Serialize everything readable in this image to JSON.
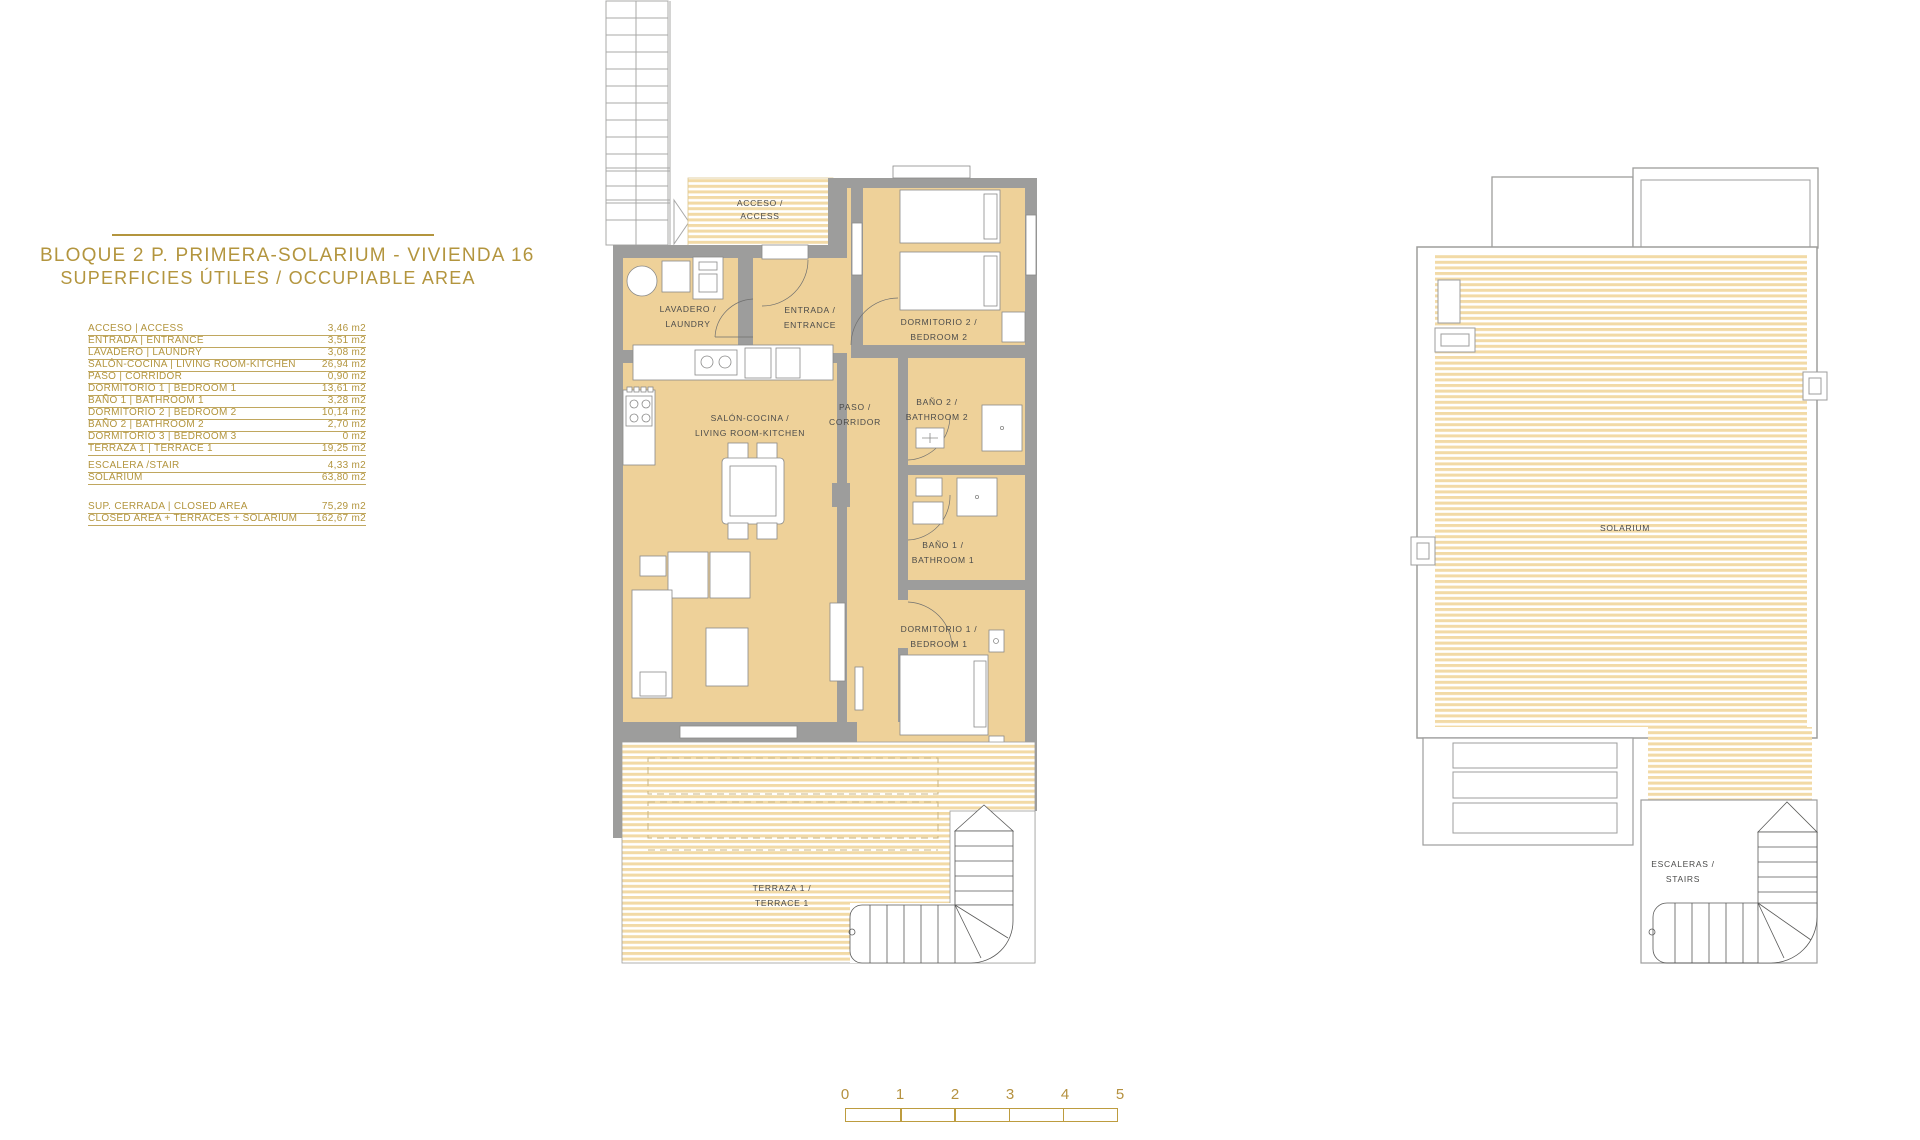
{
  "title_block": {
    "line1": "BLOQUE 2 P. PRIMERA-SOLARIUM - VIVIENDA 16",
    "line2": "SUPERFICIES ÚTILES / OCCUPIABLE AREA"
  },
  "area_table": {
    "rows": [
      {
        "label": "ACCESO | ACCESS",
        "value": "3,46 m2"
      },
      {
        "label": "ENTRADA | ENTRANCE",
        "value": "3,51 m2"
      },
      {
        "label": "LAVADERO | LAUNDRY",
        "value": "3,08 m2"
      },
      {
        "label": "SALÓN-COCINA | LIVING ROOM-KITCHEN",
        "value": "26,94 m2"
      },
      {
        "label": "PASO | CORRIDOR",
        "value": "0,90 m2"
      },
      {
        "label": "DORMITORIO 1 | BEDROOM 1",
        "value": "13,61 m2"
      },
      {
        "label": "BAÑO 1 | BATHROOM 1",
        "value": "3,28 m2"
      },
      {
        "label": "DORMITORIO 2 | BEDROOM 2",
        "value": "10,14 m2"
      },
      {
        "label": "BAÑO 2 | BATHROOM 2",
        "value": "2,70 m2"
      },
      {
        "label": "DORMITORIO 3 | BEDROOM 3",
        "value": "0 m2"
      },
      {
        "label": "TERRAZA 1 | TERRACE 1",
        "value": "19,25 m2"
      },
      {
        "label": "ESCALERA /STAIR",
        "value": "4,33 m2"
      },
      {
        "label": "SOLARIUM",
        "value": "63,80 m2"
      }
    ],
    "totals": [
      {
        "label": "SUP. CERRADA | CLOSED AREA",
        "value": "75,29 m2"
      },
      {
        "label": "CLOSED AREA + TERRACES + SOLARIUM",
        "value": "162,67 m2"
      }
    ]
  },
  "left_plan": {
    "labels": {
      "acceso": [
        "ACCESO /",
        "ACCESS"
      ],
      "lavadero": [
        "LAVADERO /",
        "LAUNDRY"
      ],
      "entrada": [
        "ENTRADA /",
        "ENTRANCE"
      ],
      "dormitorio2": [
        "DORMITORIO 2 /",
        "BEDROOM 2"
      ],
      "salon": [
        "SALÓN-COCINA /",
        "LIVING ROOM-KITCHEN"
      ],
      "paso": [
        "PASO /",
        "CORRIDOR"
      ],
      "bano2": [
        "BAÑO 2 /",
        "BATHROOM 2"
      ],
      "bano1": [
        "BAÑO 1 /",
        "BATHROOM 1"
      ],
      "dormitorio1": [
        "DORMITORIO 1 /",
        "BEDROOM 1"
      ],
      "terraza": [
        "TERRAZA 1 /",
        "TERRACE 1"
      ]
    }
  },
  "right_plan": {
    "labels": {
      "solarium": "SOLARIUM",
      "escaleras": [
        "ESCALERAS /",
        "STAIRS"
      ]
    }
  },
  "scale_bar": {
    "ticks": [
      "0",
      "1",
      "2",
      "3",
      "4",
      "5"
    ]
  },
  "colors": {
    "gold_text": "#b3953e",
    "scale_gold": "#bd9c3f",
    "room_fill": "#eed199",
    "stripe_fill": "#f2daa6",
    "wall_gray": "#9d9d9c",
    "plan_text": "#4b4b4a"
  }
}
